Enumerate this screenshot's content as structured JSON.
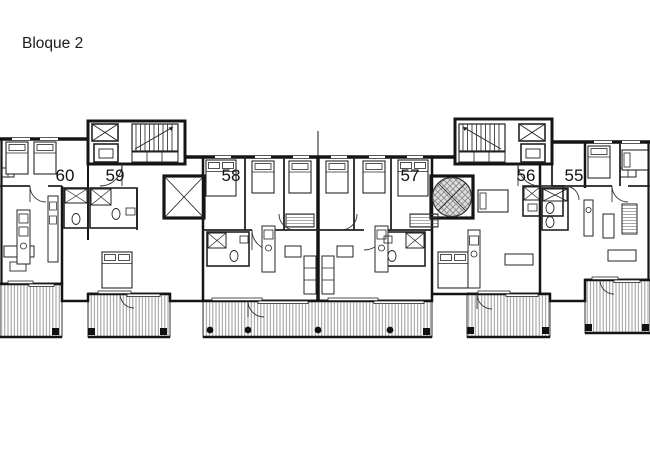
{
  "title": "Bloque 2",
  "units": [
    {
      "label": "60"
    },
    {
      "label": "59"
    },
    {
      "label": "58"
    },
    {
      "label": "57"
    },
    {
      "label": "56"
    },
    {
      "label": "55"
    }
  ],
  "plan": {
    "type": "apartment-floor-plan",
    "features": [
      "stair-core-left",
      "stair-core-right",
      "elevators",
      "square-patio",
      "round-patio",
      "terraces"
    ]
  },
  "colors": {
    "line": "#141414",
    "terrace_hatch": "#8f8f8f",
    "patio_fill": "#d9d9d9",
    "background": "#ffffff"
  }
}
